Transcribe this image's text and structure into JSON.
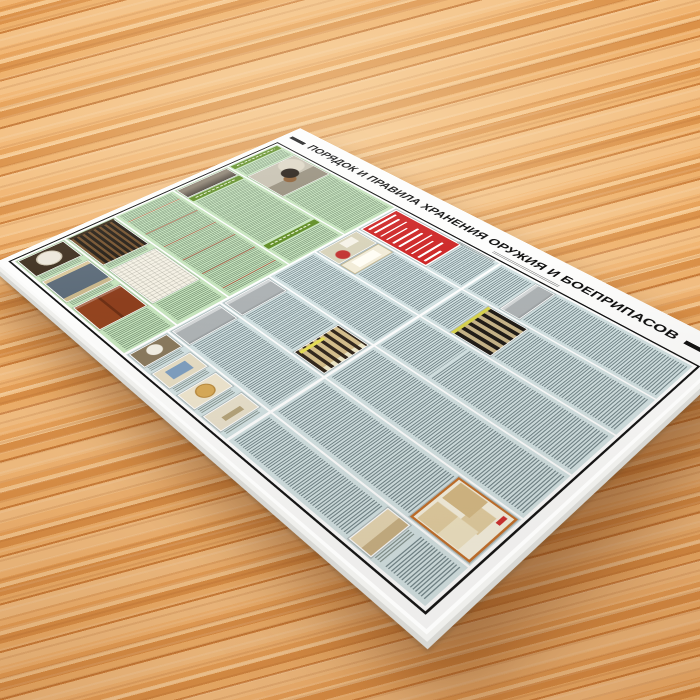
{
  "poster": {
    "title": "ПОРЯДОК И ПРАВИЛА ХРАНЕНИЯ ОРУЖИЯ И БОЕПРИПАСОВ",
    "language": "ru",
    "paper_color": "#fdfdfc",
    "frame_color": "#141414",
    "sections": {
      "top_band": {
        "background_color": "#c6e4bd",
        "header_bar_color": "#5e8c22",
        "accent_heading_color": "#c43c2a",
        "description": "columns of storage-rule text with photos of a seal, safe door, wooden cabinet, grille door, floor plan and a guard dog"
      },
      "bottom_band": {
        "background_color": "#d3e2e3",
        "description": "two rows of dense micro-text columns with photos of metal cabinets, weapon racks, storage rooms and permit documents"
      },
      "alert_box": {
        "background_color": "#ce2727",
        "text_color": "#ffffff",
        "line_count": 10
      }
    },
    "photos": [
      {
        "name": "metal-seal-photo",
        "desc": "round seal plate in dark frame"
      },
      {
        "name": "safe-door-photo",
        "desc": "steel safe door"
      },
      {
        "name": "wooden-cabinet-photo",
        "desc": "red-brown wooden gun cabinet"
      },
      {
        "name": "grille-door-photo",
        "desc": "metal grille door"
      },
      {
        "name": "floor-plan-photo",
        "desc": "storage room floor plan"
      },
      {
        "name": "guard-dog-photo",
        "desc": "guard dog with handler"
      },
      {
        "name": "metal-cabinet-photo",
        "desc": "grey metal storage cabinets"
      },
      {
        "name": "weapons-rack-photo",
        "desc": "rack pyramid with rifles"
      },
      {
        "name": "weapons-rack2-photo",
        "desc": "second rack with rifles and labels"
      },
      {
        "name": "documents-photo",
        "desc": "storage permits and documents in orange frame"
      },
      {
        "name": "room-interior-photos",
        "desc": "small photos of storage room details"
      },
      {
        "name": "wall-sign-photo",
        "desc": "room wall with round warning sign and framed certificate"
      }
    ]
  },
  "environment": {
    "surface": "wooden table",
    "wood_tones": [
      "#f1b572",
      "#e7a158",
      "#f5c68c",
      "#db9148",
      "#cd7f3a"
    ]
  }
}
